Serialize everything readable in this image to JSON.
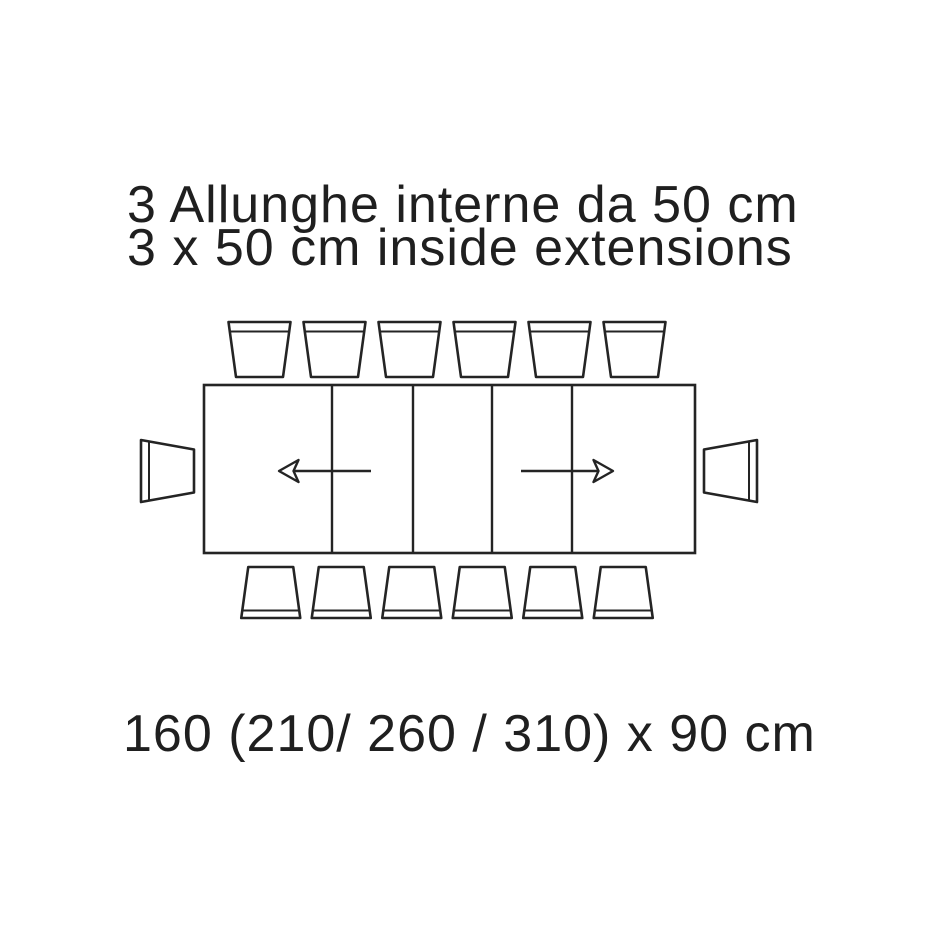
{
  "page": {
    "background_color": "#ffffff",
    "line_color": "#242424",
    "text_color": "#1f1f1f"
  },
  "title": {
    "line1_it": "3 Allunghe interne da 50 cm",
    "line2_en": "3 x 50 cm inside extensions"
  },
  "dimensions": {
    "label": "160 (210/ 260 / 310) x 90 cm",
    "base_length_cm": "160",
    "extended_lengths_cm": [
      "210",
      "260",
      "310"
    ],
    "depth_cm": "90"
  },
  "diagram": {
    "description": "Top view of rectangular extendable table with chairs",
    "table_sections": 5,
    "top_chairs": 6,
    "bottom_chairs": 6,
    "end_chairs": 2,
    "extension_arrows": [
      "left",
      "right"
    ]
  }
}
